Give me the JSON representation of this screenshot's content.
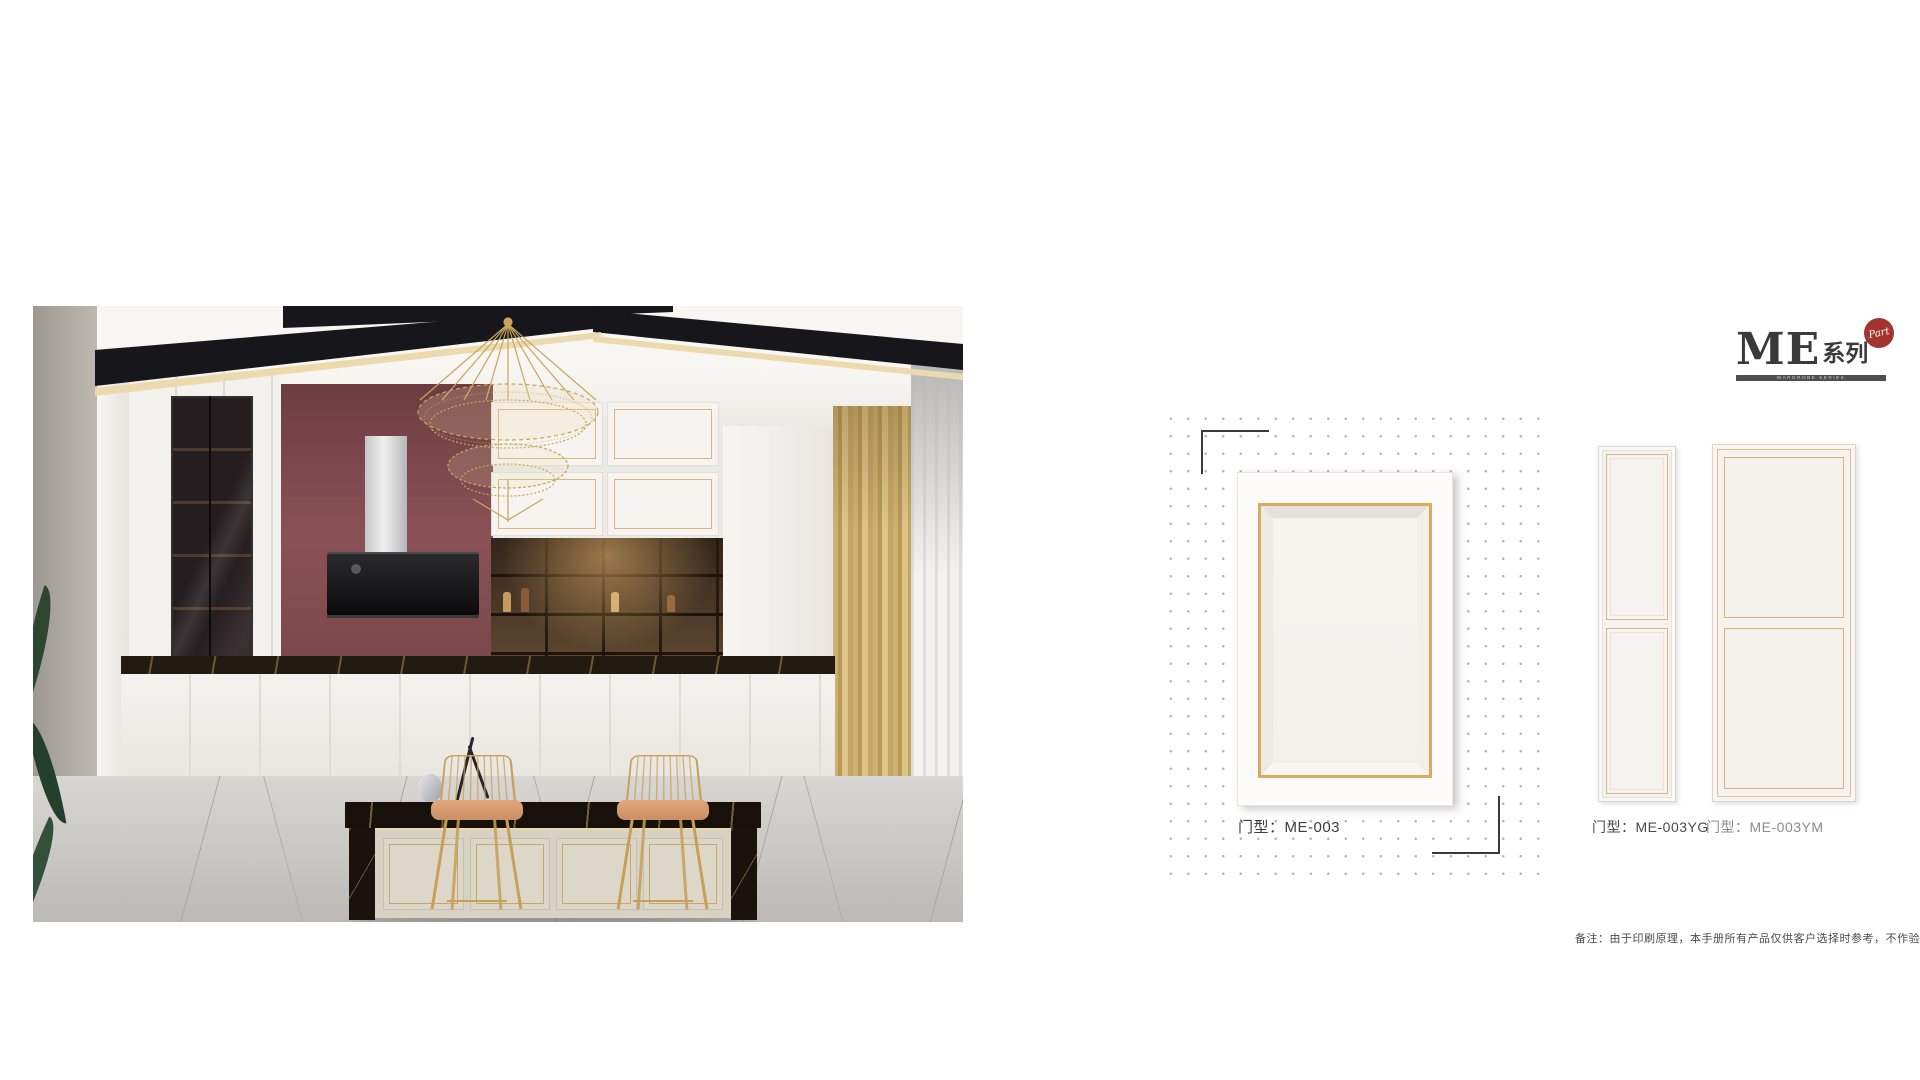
{
  "logo": {
    "me": "ME",
    "series": "系列",
    "badge": "Part",
    "tagline": "WARDROBE SERIES"
  },
  "products": {
    "main": {
      "label": "门型：ME-003"
    },
    "narrow": {
      "label": "门型：ME-003YG"
    },
    "wide": {
      "label": "门型：ME-003YM"
    }
  },
  "footer": {
    "disclaimer": "备注：由于印刷原理，本手册所有产品仅供客户选择时参考，不作验收标准。",
    "page_number": "07/08"
  },
  "palette": {
    "gold_trim": "#dcaa5e",
    "badge_red": "#a33430",
    "maroon_wall": "#82484d",
    "curtain_gold": "#c3a566",
    "marble_dark": "#221910",
    "floor_gray": "#c6c4c1"
  }
}
